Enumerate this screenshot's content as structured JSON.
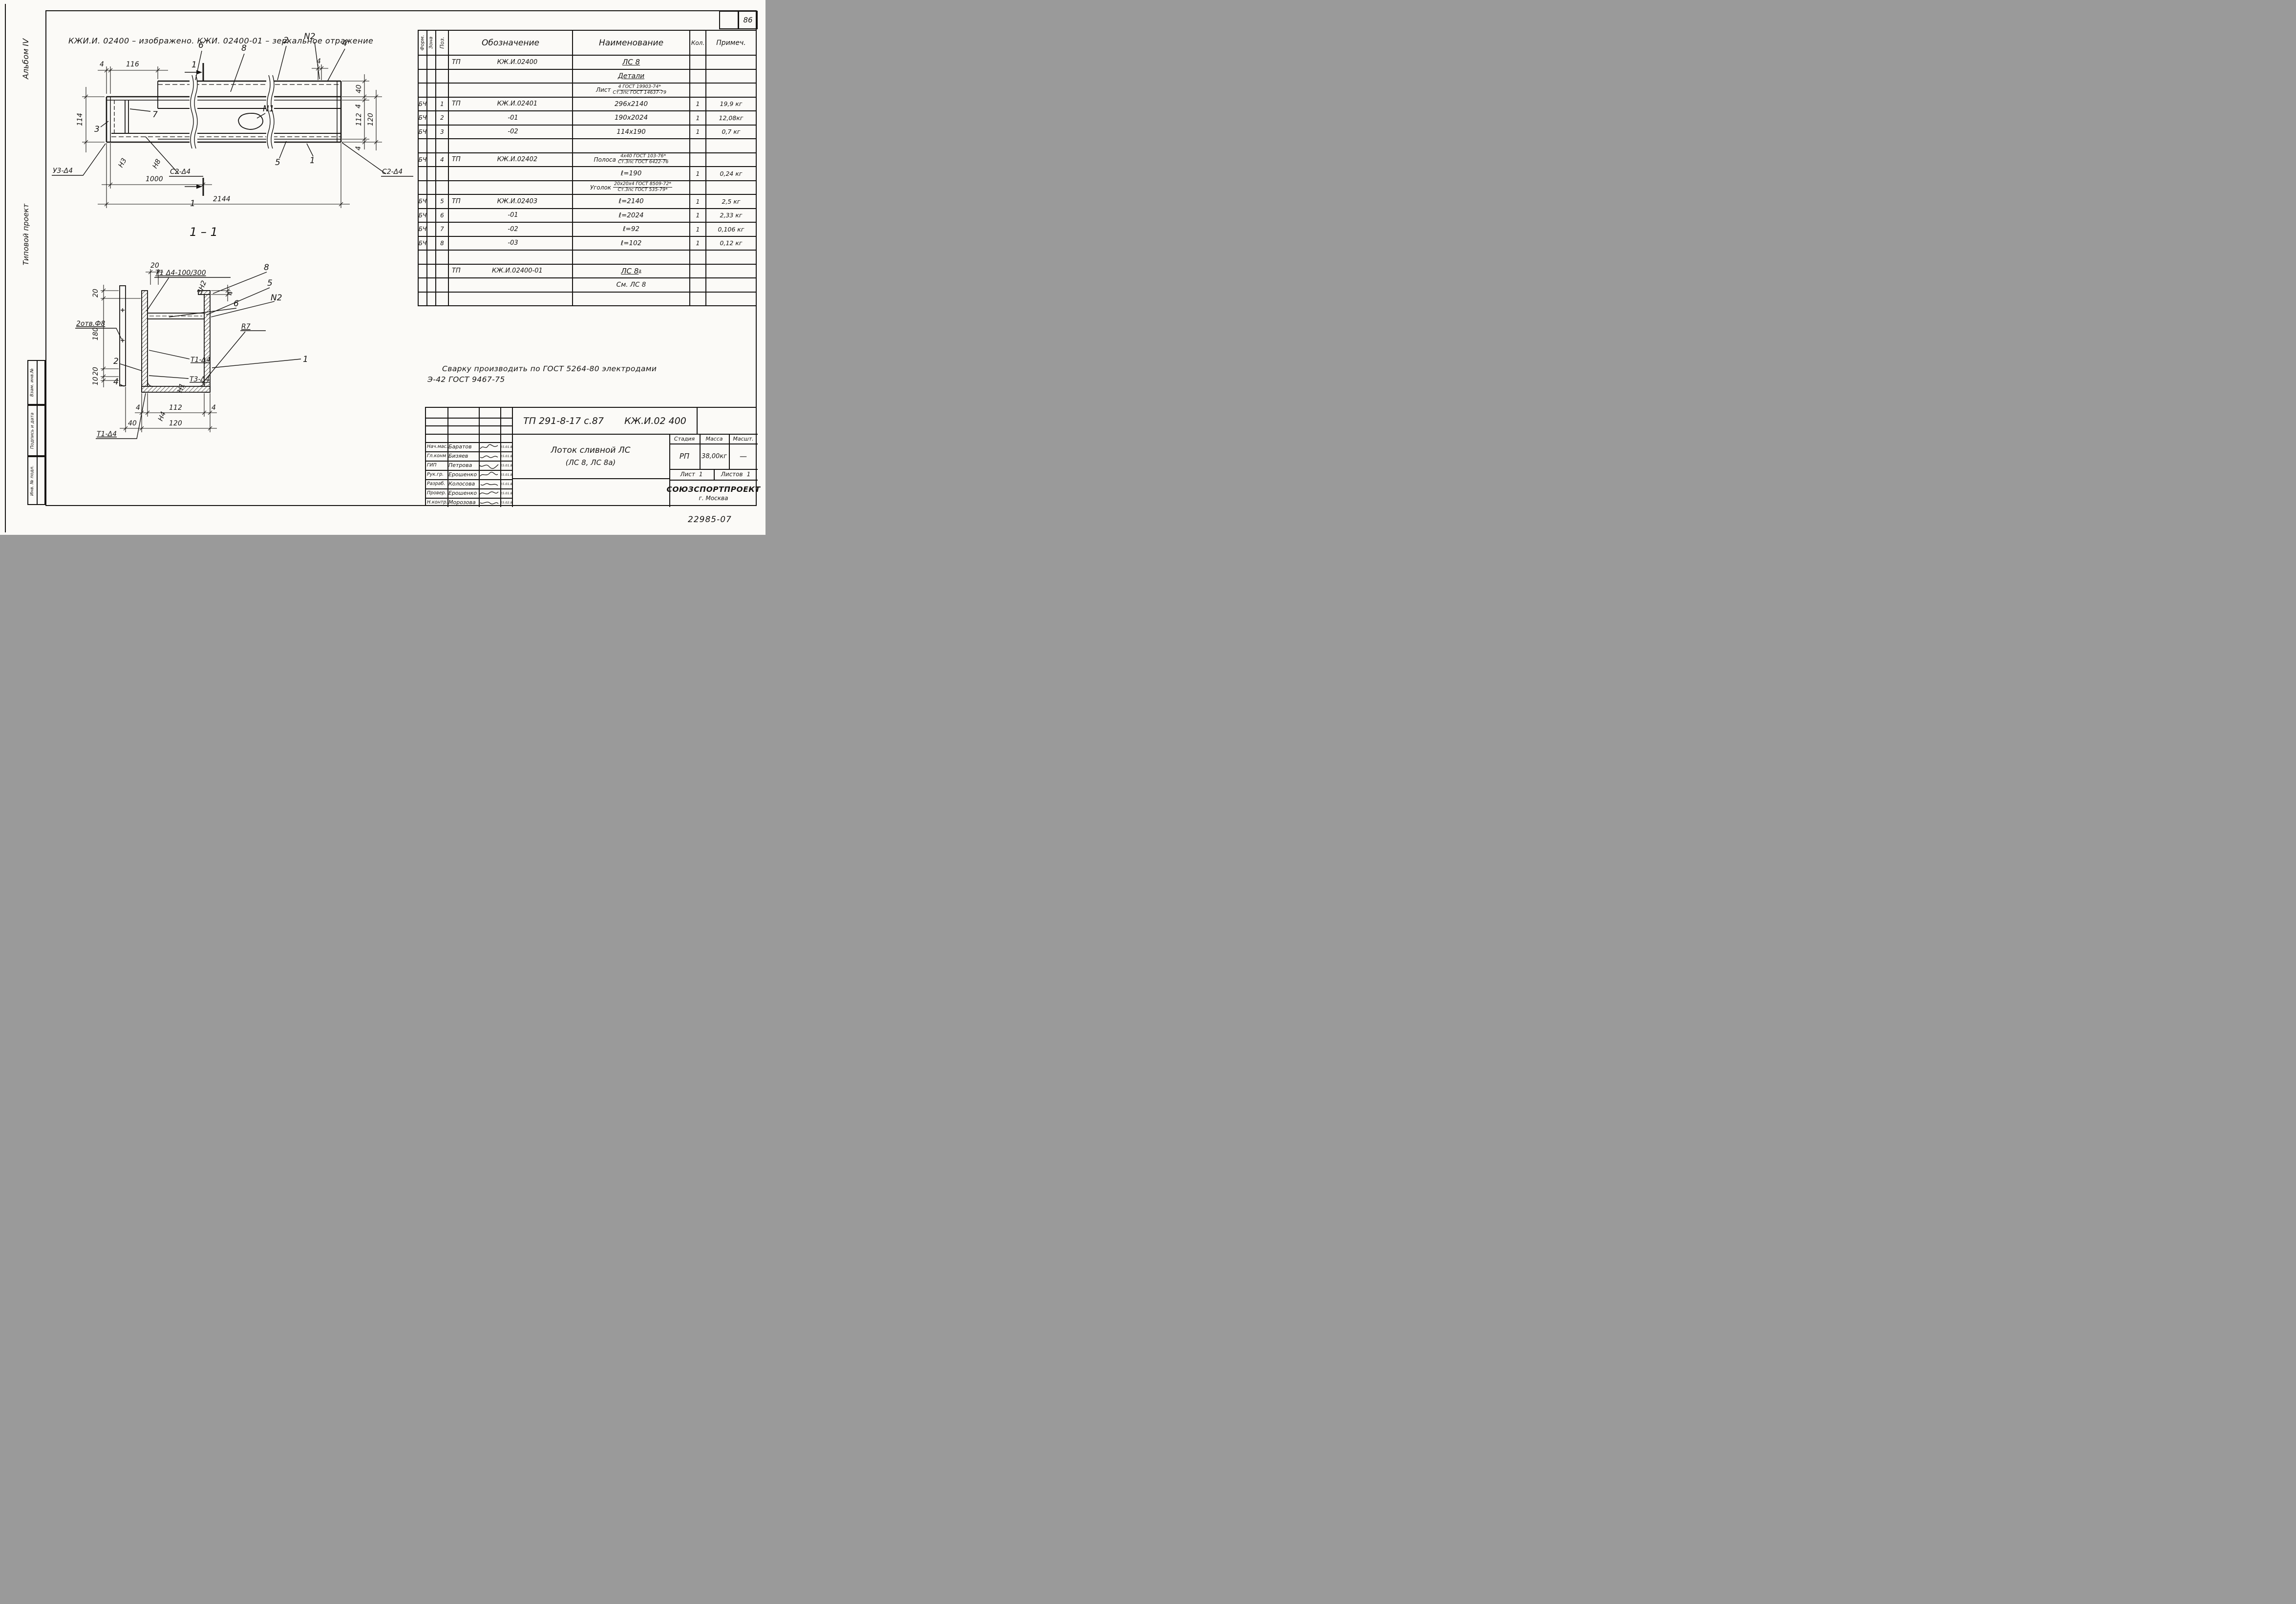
{
  "page": {
    "number": "86",
    "doc_code": "22985-07",
    "paper_color": "#fbfaf7",
    "ink_color": "#171513"
  },
  "sidebar": {
    "album": "Альбом IV",
    "project_type": "Типовой проект",
    "stamp_boxes": [
      {
        "label": "Взам. инв.№"
      },
      {
        "label": "Подпись и дата"
      },
      {
        "label": "Инв. № подл."
      }
    ]
  },
  "header_note": "КЖИ.И. 02400 – изображено.  КЖИ. 02400-01 – зеркальное отражение",
  "weld_note": {
    "line1": "Сварку  производить  по  ГОСТ 5264-80  электродами",
    "line2": "Э-42  ГОСТ 9467-75"
  },
  "spec_table": {
    "headers": {
      "form": "Форм.",
      "zona": "Зона",
      "poz": "Поз.",
      "oboz": "Обозначение",
      "naim": "Наименование",
      "kol": "Кол.",
      "prim": "Примеч."
    },
    "rows": [
      {
        "oboz_l": "ТП",
        "oboz_r": "КЖ.И.02400",
        "naim": "ЛС 8"
      },
      {
        "naim": "Детали"
      },
      {
        "naim_prefix": "Лист",
        "naim_top": "4 ГОСТ 19903-74*",
        "naim_bottom": "Ст.3пс ГОСТ 14637-79"
      },
      {
        "form": "БЧ",
        "poz": "1",
        "oboz_l": "ТП",
        "oboz_r": "КЖ.И.02401",
        "naim": "296х2140",
        "kol": "1",
        "prim": "19,9 кг"
      },
      {
        "form": "БЧ",
        "poz": "2",
        "oboz_r": "-01",
        "naim": "190х2024",
        "kol": "1",
        "prim": "12,08кг"
      },
      {
        "form": "БЧ",
        "poz": "3",
        "oboz_r": "-02",
        "naim": "114х190",
        "kol": "1",
        "prim": "0,7 кг"
      },
      {},
      {
        "form": "БЧ",
        "poz": "4",
        "oboz_l": "ТП",
        "oboz_r": "КЖ.И.02402",
        "naim_prefix": "Полоса",
        "naim_top": "4х40 ГОСТ 103-76*",
        "naim_bottom": "Ст.3пс ГОСТ 6422-76"
      },
      {
        "naim": "ℓ=190",
        "kol": "1",
        "prim": "0,24 кг"
      },
      {
        "naim_prefix": "Уголок",
        "naim_top": "20х20х4 ГОСТ 8509-72*",
        "naim_bottom": "Ст.3пс ГОСТ 535-79*"
      },
      {
        "form": "БЧ",
        "poz": "5",
        "oboz_l": "ТП",
        "oboz_r": "КЖ.И.02403",
        "naim": "ℓ=2140",
        "kol": "1",
        "prim": "2,5 кг"
      },
      {
        "form": "БЧ",
        "poz": "6",
        "oboz_r": "-01",
        "naim": "ℓ=2024",
        "kol": "1",
        "prim": "2,33 кг"
      },
      {
        "form": "БЧ",
        "poz": "7",
        "oboz_r": "-02",
        "naim": "ℓ=92",
        "kol": "1",
        "prim": "0,106 кг"
      },
      {
        "form": "БЧ",
        "poz": "8",
        "oboz_r": "-03",
        "naim": "ℓ=102",
        "kol": "1",
        "prim": "0,12 кг"
      },
      {},
      {
        "oboz_l": "ТП",
        "oboz_r": "КЖ.И.02400-01",
        "naim": "ЛС 8",
        "naim_sup": "а"
      },
      {
        "naim": "См. ЛС 8"
      },
      {}
    ]
  },
  "plan_view": {
    "dims": {
      "top_4": "4",
      "top_116": "116",
      "left_114": "114",
      "right_40": "40",
      "right_4a": "4",
      "right_112": "112",
      "right_4b": "4",
      "right_120": "120",
      "thk_4": "4",
      "bottom_1000": "1000",
      "bottom_2144": "2144"
    },
    "callouts": {
      "p6": "6",
      "p8": "8",
      "p2": "2",
      "n2": "N2",
      "p4": "4",
      "p7": "7",
      "p3": "3",
      "n1": "N1",
      "p5": "5",
      "p1": "1",
      "sec_top": "1",
      "sec_bottom": "1",
      "u3": "У3-Δ4",
      "n3": "Н3",
      "s2_left": "С2-Δ4",
      "n8": "Н8",
      "s2_right": "С2-Δ4"
    }
  },
  "section_view": {
    "title": "1 – 1",
    "dims": {
      "top_20": "20",
      "left_20a": "20",
      "left_180": "180",
      "left_20b": "20",
      "left_10": "10",
      "right_4": "4",
      "bot_4a": "4",
      "bot_112": "112",
      "bot_4b": "4",
      "bot_40": "40",
      "bot_120": "120"
    },
    "labels": {
      "holes": "2отв.Ф8",
      "weld_t1": "Т1 Δ4-100/300",
      "c8": "8",
      "c5": "5",
      "n2": "N2",
      "c6": "6",
      "zn2": "3Н2",
      "c2": "2",
      "c4": "4",
      "t1": "Т1-Δ4",
      "t3": "Т3-Δ4",
      "n1": "Н1",
      "c1": "1",
      "r7": "R7",
      "n4": "Н4",
      "t1b": "Т1-Δ4"
    }
  },
  "title_block": {
    "doc_left": "ТП 291-8-17 с.87",
    "doc_right": "КЖ.И.02 400",
    "personnel": [
      {
        "role": "Нач.мас.",
        "name": "Баратов",
        "date": "15.01.87"
      },
      {
        "role": "Гл.конм",
        "name": "Бизяев",
        "date": "15.01.87"
      },
      {
        "role": "ГИП",
        "name": "Петрова",
        "date": "15.01.87"
      },
      {
        "role": "Рук.гр.",
        "name": "Ерошенко",
        "date": "15.01.87"
      },
      {
        "role": "Разраб.",
        "name": "Колосова",
        "date": "15.01.87"
      },
      {
        "role": "Провер.",
        "name": "Ерошенко",
        "date": "15.01.87"
      },
      {
        "role": "Н.контр.",
        "name": "Морозова",
        "date": "15.02.87"
      }
    ],
    "title_line1": "Лоток сливной ЛС",
    "title_line2": "(ЛС 8, ЛС 8а)",
    "stage_header": {
      "stage": "Стадия",
      "mass": "Масса",
      "scale": "Масшт."
    },
    "stage_values": {
      "stage": "РП",
      "mass": "38,00кг",
      "scale": "—"
    },
    "sheet": {
      "list_label": "Лист",
      "list_value": "1",
      "listov_label": "Листов",
      "listov_value": "1"
    },
    "org": {
      "name": "СОЮЗСПОРТПРОЕКТ",
      "city": "г. Москва"
    }
  }
}
